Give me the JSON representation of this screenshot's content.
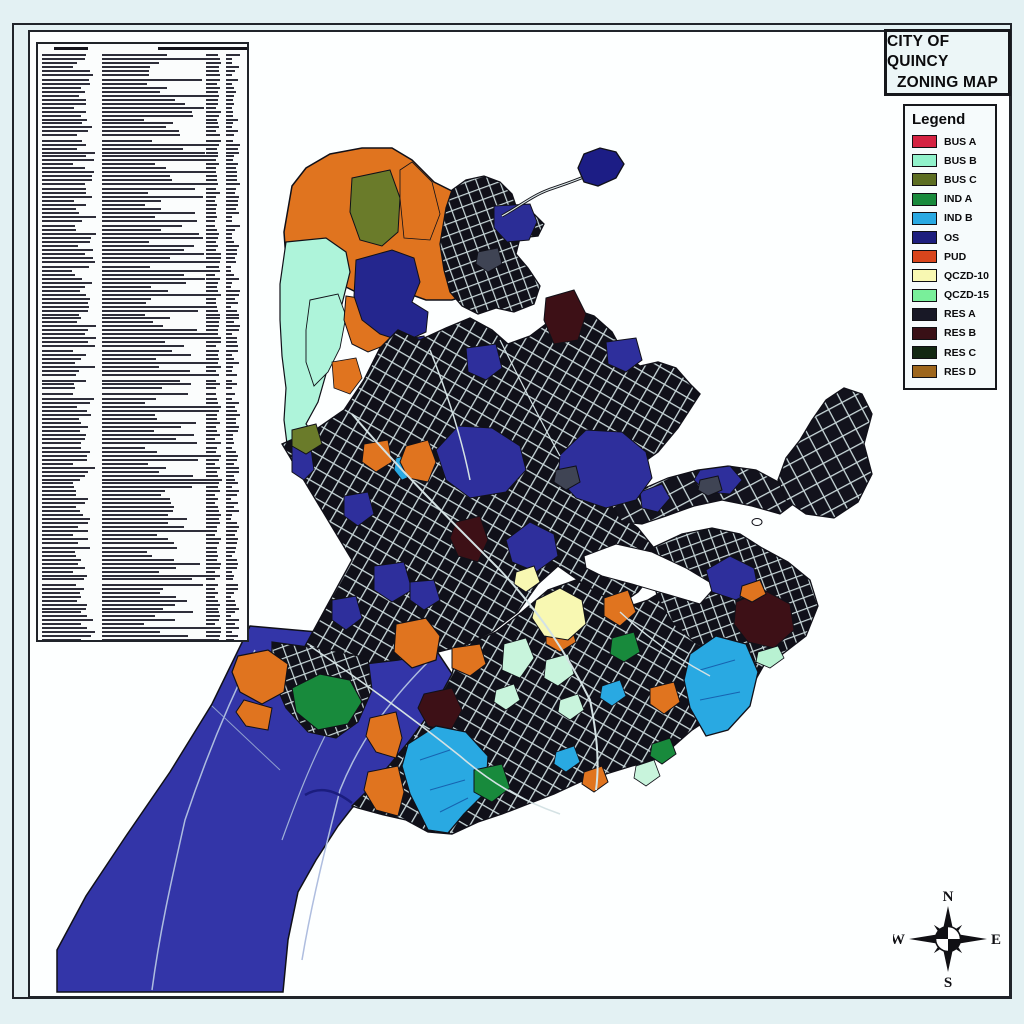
{
  "title": {
    "line1": "CITY OF QUINCY",
    "line2": "ZONING MAP"
  },
  "legend": {
    "title": "Legend",
    "items": [
      {
        "label": "BUS A",
        "color": "#d42342"
      },
      {
        "label": "BUS B",
        "color": "#90f2cb"
      },
      {
        "label": "BUS C",
        "color": "#5c6e22"
      },
      {
        "label": "IND A",
        "color": "#188a3c"
      },
      {
        "label": "IND B",
        "color": "#29a9e2"
      },
      {
        "label": "OS",
        "color": "#1d1e7e"
      },
      {
        "label": "PUD",
        "color": "#d8451c"
      },
      {
        "label": "QCZD-10",
        "color": "#f8f8b2"
      },
      {
        "label": "QCZD-15",
        "color": "#79ef9a"
      },
      {
        "label": "RES A",
        "color": "#181826"
      },
      {
        "label": "RES B",
        "color": "#391016"
      },
      {
        "label": "RES C",
        "color": "#122812"
      },
      {
        "label": "RES D",
        "color": "#9d661c"
      }
    ]
  },
  "compass": {
    "n": "N",
    "s": "S",
    "e": "E",
    "w": "W"
  },
  "amendments_table": {
    "visible_rows": 148
  }
}
